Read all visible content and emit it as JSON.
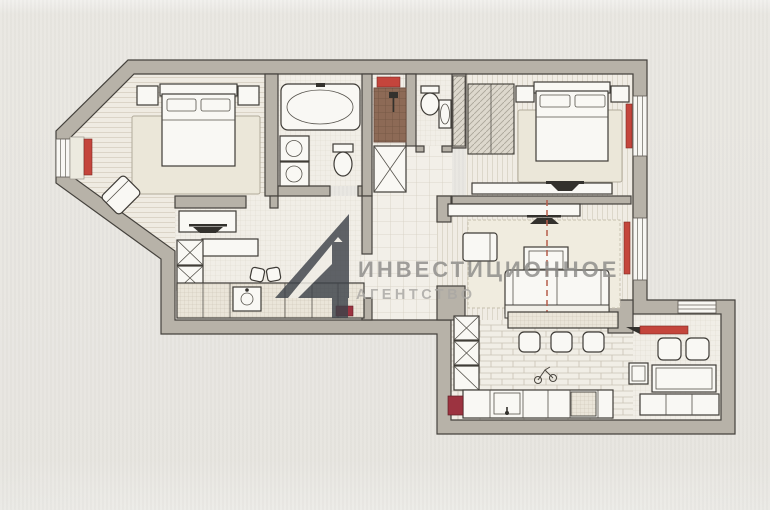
{
  "meta": {
    "kind": "apartment-floor-plan-photo",
    "language": "ru",
    "labels_on_plan": "none"
  },
  "watermark": {
    "line1": "ИНВЕСТИЦИОННОЕ",
    "line2": "АГЕНТСТВО",
    "logo": "dark-triangle-monogram",
    "text_color": "#8d8c89",
    "line2_color": "#aaa8a4",
    "logo_color": "#3e434a"
  },
  "palette": {
    "background": "#e8e6e1",
    "paper_floor": "#f0ede6",
    "wall_fill": "#b7b2a8",
    "wall_stroke": "#45423d",
    "rug": "#ebe7d9",
    "radiator_red": "#c4453c",
    "accent_dark_red": "#9c3340",
    "entry_mat_brown": "#8d6a56",
    "section_line_red": "#b65c4a"
  },
  "plan": {
    "rooms": [
      {
        "id": "bedroom-1",
        "position": "top-left",
        "features": [
          "bay-window",
          "window-radiator",
          "double-bed",
          "two-nightstands",
          "rug",
          "corner-armchair"
        ]
      },
      {
        "id": "bathroom",
        "position": "top-center",
        "features": [
          "bathtub",
          "washing-machine",
          "dryer",
          "toilet"
        ]
      },
      {
        "id": "entry-hall",
        "position": "top-center-right",
        "features": [
          "entrance-door-lintel",
          "doormat",
          "closet-with-cross"
        ]
      },
      {
        "id": "wc",
        "position": "top-center-right",
        "features": [
          "wall-hung-toilet",
          "washbasin"
        ]
      },
      {
        "id": "bedroom-2",
        "position": "top-right",
        "features": [
          "wardrobe",
          "double-bed",
          "two-nightstands",
          "rug",
          "tv-unit",
          "window-radiator"
        ]
      },
      {
        "id": "kitchen",
        "position": "center-left",
        "features": [
          "upper-unit-with-hood",
          "shelf",
          "appliance-column",
          "counter-with-sink",
          "dark-red-accent"
        ]
      },
      {
        "id": "hallway",
        "position": "center",
        "features": [
          "tiled-floor"
        ]
      },
      {
        "id": "living-room",
        "position": "center-right",
        "features": [
          "tv-unit",
          "armchair",
          "coffee-table",
          "sofa",
          "rug",
          "window-radiator",
          "red-section-line"
        ]
      },
      {
        "id": "dining-kitchen",
        "position": "bottom-center",
        "features": [
          "bar-counter",
          "three-bar-stools",
          "appliance-column",
          "counter-with-sink",
          "dishwasher",
          "red-cabinet",
          "small-sketch"
        ]
      },
      {
        "id": "balcony",
        "position": "bottom-right",
        "features": [
          "horizontal-radiator",
          "cabinet",
          "two-chairs",
          "table",
          "bench",
          "window-band"
        ]
      }
    ]
  }
}
